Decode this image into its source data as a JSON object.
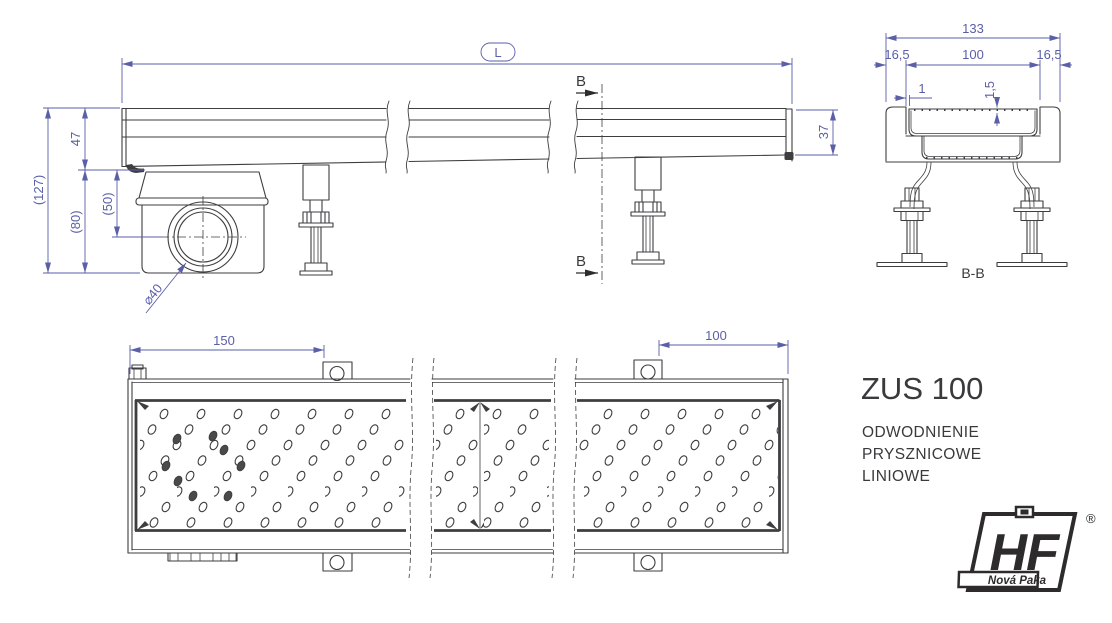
{
  "title_block": {
    "product_name": "ZUS 100",
    "description_line1": "ODWODNIENIE",
    "description_line2": "PRYSZNICOWE",
    "description_line3": "LINIOWE"
  },
  "side_view": {
    "length_label": "L",
    "channel_height": "47",
    "total_height": "(127)",
    "trap_body_height": "(80)",
    "outlet_axis_height": "(50)",
    "outlet_diameter": "⌀40",
    "end_height": "37",
    "section_letter_top": "B",
    "section_letter_bottom": "B"
  },
  "section_view": {
    "view_label": "B-B",
    "overall_width": "133",
    "left_edge_width": "16,5",
    "grate_width": "100",
    "right_edge_width": "16,5",
    "grate_side_gap": "1",
    "grate_thickness": "1,5"
  },
  "top_view": {
    "outlet_end_offset": "150",
    "far_end_offset": "100"
  },
  "brand": {
    "logo_letters": "HF",
    "logo_city": "Nová Paka",
    "registered_symbol": "®"
  },
  "colors": {
    "line_color": "#3e3e40",
    "dimension_color": "#5a5fa8",
    "background": "#ffffff"
  }
}
